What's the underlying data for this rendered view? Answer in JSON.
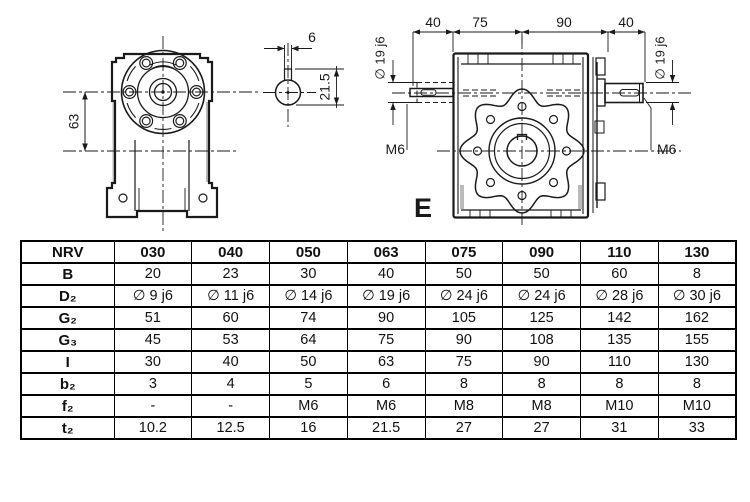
{
  "drawing": {
    "front_view": {
      "height_dim": "63"
    },
    "shaft_section": {
      "key_width_dim": "6",
      "key_depth_dim": "21.5"
    },
    "side_view": {
      "top_dims": [
        "40",
        "75",
        "90",
        "40"
      ],
      "shaft_dim_left": "∅ 19 j6",
      "shaft_dim_right": "∅ 19 j6",
      "tap_left": "M6",
      "tap_right": "M6",
      "view_label": "E"
    }
  },
  "table": {
    "header": {
      "label": "NRV",
      "columns": [
        "030",
        "040",
        "050",
        "063",
        "075",
        "090",
        "110",
        "130"
      ]
    },
    "rows": [
      {
        "label": "B",
        "values": [
          "20",
          "23",
          "30",
          "40",
          "50",
          "50",
          "60",
          "8"
        ]
      },
      {
        "label": "D₂",
        "values": [
          "∅ 9 j6",
          "∅ 11 j6",
          "∅ 14 j6",
          "∅ 19 j6",
          "∅ 24 j6",
          "∅ 24 j6",
          "∅ 28 j6",
          "∅ 30 j6"
        ]
      },
      {
        "label": "G₂",
        "values": [
          "51",
          "60",
          "74",
          "90",
          "105",
          "125",
          "142",
          "162"
        ]
      },
      {
        "label": "G₃",
        "values": [
          "45",
          "53",
          "64",
          "75",
          "90",
          "108",
          "135",
          "155"
        ]
      },
      {
        "label": "I",
        "values": [
          "30",
          "40",
          "50",
          "63",
          "75",
          "90",
          "110",
          "130"
        ]
      },
      {
        "label": "b₂",
        "values": [
          "3",
          "4",
          "5",
          "6",
          "8",
          "8",
          "8",
          "8"
        ]
      },
      {
        "label": "f₂",
        "values": [
          "-",
          "-",
          "M6",
          "M6",
          "M8",
          "M8",
          "M10",
          "M10"
        ]
      },
      {
        "label": "t₂",
        "values": [
          "10.2",
          "12.5",
          "16",
          "21.5",
          "27",
          "27",
          "31",
          "33"
        ]
      }
    ]
  },
  "colors": {
    "line": "#1a1a1a",
    "table_border": "#000000",
    "background": "#ffffff",
    "shading": "#bbbbbb"
  }
}
